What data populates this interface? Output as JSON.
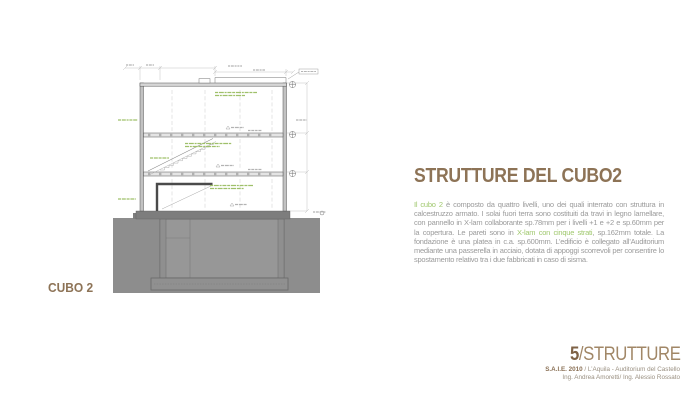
{
  "drawing": {
    "caption": "CUBO 2"
  },
  "content": {
    "title": "STRUTTURE DEL CUBO2",
    "paragraph": {
      "seg1": "Il cubo 2",
      "seg2": " è composto da quattro livelli, uno dei quali interrato con struttura in calcestruzzo armato. I solai fuori terra sono costituiti da travi in legno lamellare, con pannello in X-lam collaborante sp.78mm per i livelli +1 e +2 e sp.60mm per la copertura. Le pareti sono in ",
      "seg3": "X-lam con cinque strati",
      "seg4": ", sp.162mm totale. La fondazione è una platea in c.a. sp.600mm. L’edificio è collegato all’Auditorium mediante una passerella in acciaio, dotata di appoggi scorrevoli per consentire lo spostamento relativo tra i due fabbricati in caso di sisma."
    }
  },
  "footer": {
    "number": "5",
    "section": "/STRUTTURE",
    "event": "S.A.I.E. 2010",
    "location": " / L’Aquila - Auditorium del Castello",
    "engineers": "Ing. Andrea Amoretti/ Ing. Alessio Rossato"
  },
  "colors": {
    "accent_brown": "#8d7356",
    "accent_brown_dark": "#7f6347",
    "accent_brown_light": "#a18767",
    "accent_green": "#a0c86e",
    "body_gray": "#9b9b9b",
    "credit_gray": "#998f80",
    "earth_gray": "#8d8d8d",
    "drawing_green": "#9fc06a"
  }
}
